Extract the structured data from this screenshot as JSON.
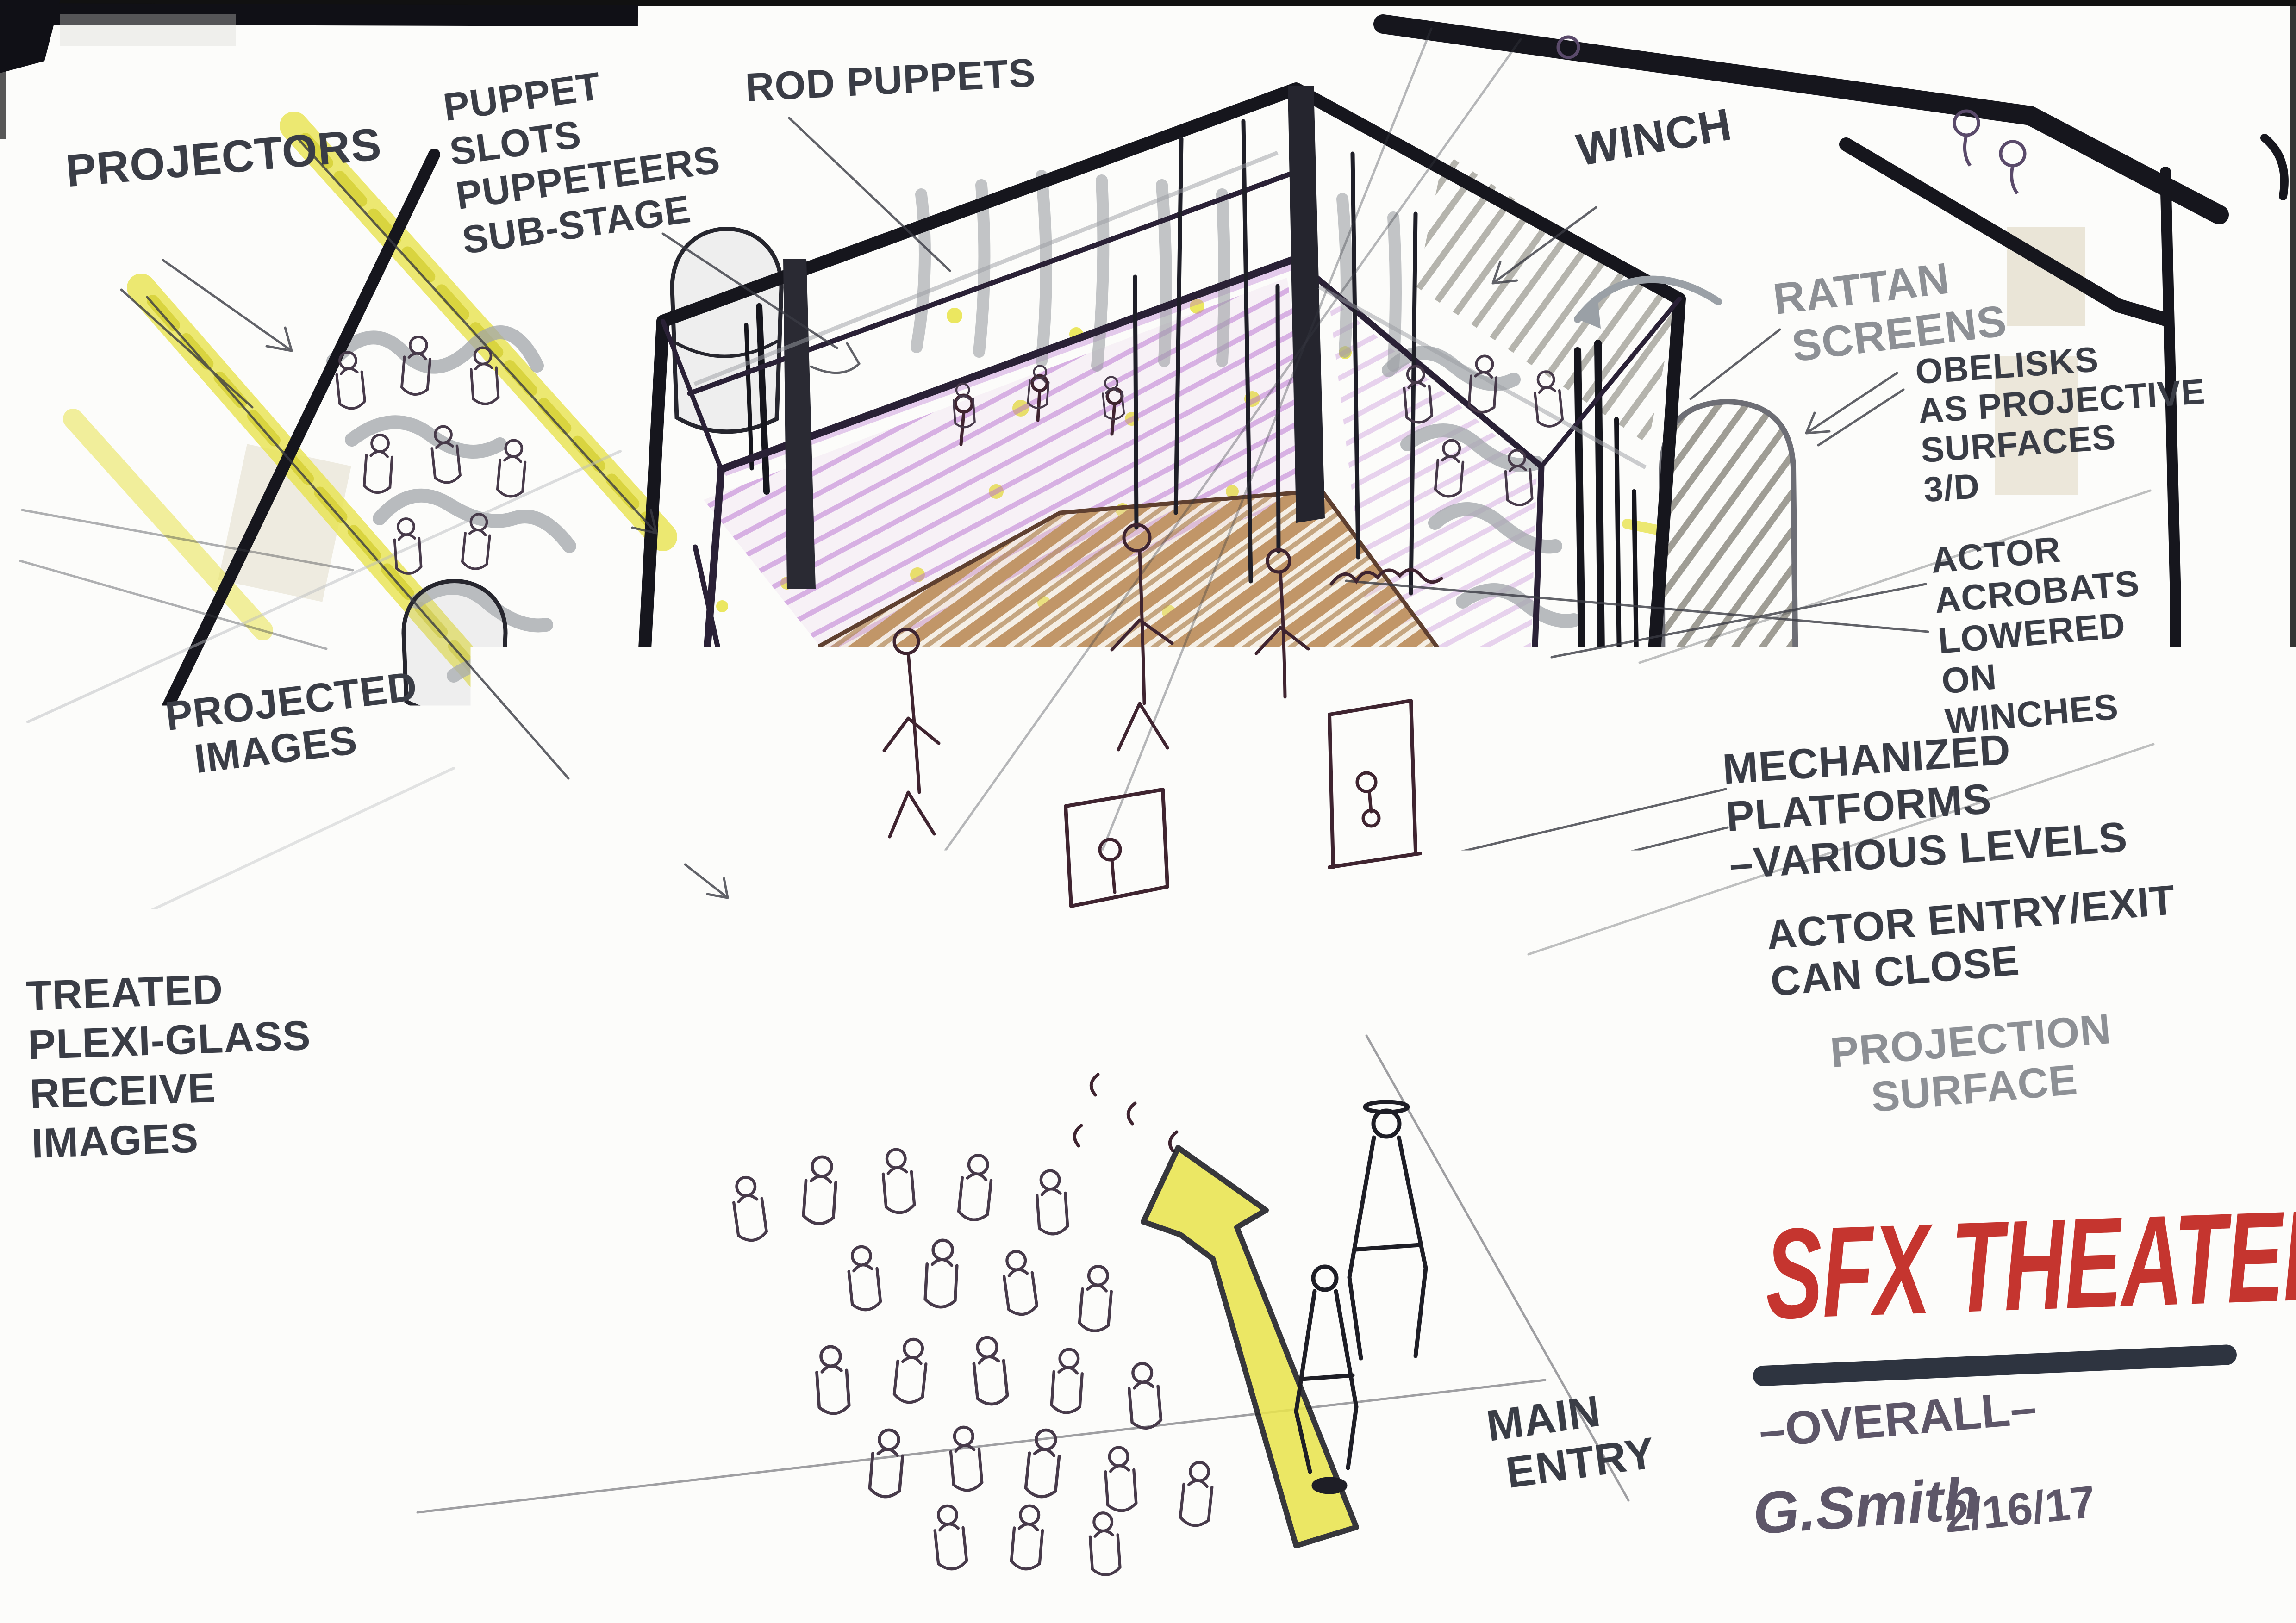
{
  "palette": {
    "paper": "#fcfcfa",
    "heavy_black": "#16161d",
    "ink_fine": "#34353e",
    "marker_slate": "#3a3d46",
    "marker_gray": "#8d9095",
    "gray_marker": "#a2a5aa",
    "inner_purple": "#2a2136",
    "purple_crayon": "#b66fd0",
    "magenta_wash": "#cf8fdc",
    "yellow_highlight": "#e9e44f",
    "stage_tan": "#c19668",
    "stage_face_dark": "#7a5232",
    "pole_brown": "#6b4a33",
    "pen_plum": "#473a4a",
    "title_red": "#c5352f",
    "title_underline": "#2e3440",
    "signature_purple": "#5d5668",
    "tape": "#ded6c0"
  },
  "annotations": {
    "projectors": "PROJECTORS",
    "puppet_slots": "PUPPET\nSLOTS\nPUPPETEERS\nSUB-STAGE",
    "rod_puppets": "ROD PUPPETS",
    "winch": "WINCH",
    "rattan_screens": "RATTAN\n SCREENS",
    "obelisks": "OBELISKS\nAS PROJECTIVE\nSURFACES\n3/D",
    "actor_acrobats": "ACTOR\nACROBATS\nLOWERED\nON\nWINCHES",
    "mechanized_platforms": "MECHANIZED\nPLATFORMS\n–VARIOUS LEVELS",
    "actor_entry": "ACTOR ENTRY/EXIT\nCAN CLOSE",
    "projection_surface": "PROJECTION\n   SURFACE",
    "projected_images": "PROJECTED\n  IMAGES",
    "treated_plexi": "TREATED\nPLEXI-GLASS\nRECEIVE\nIMAGES",
    "main_entry": "MAIN\n ENTRY"
  },
  "title_block": {
    "title": "SFX THEATER",
    "phase_label": "–OVERALL–",
    "signature": "G.Smith",
    "date": "2/16/17",
    "scale_note": "NTS",
    "sheet_number": "1"
  }
}
